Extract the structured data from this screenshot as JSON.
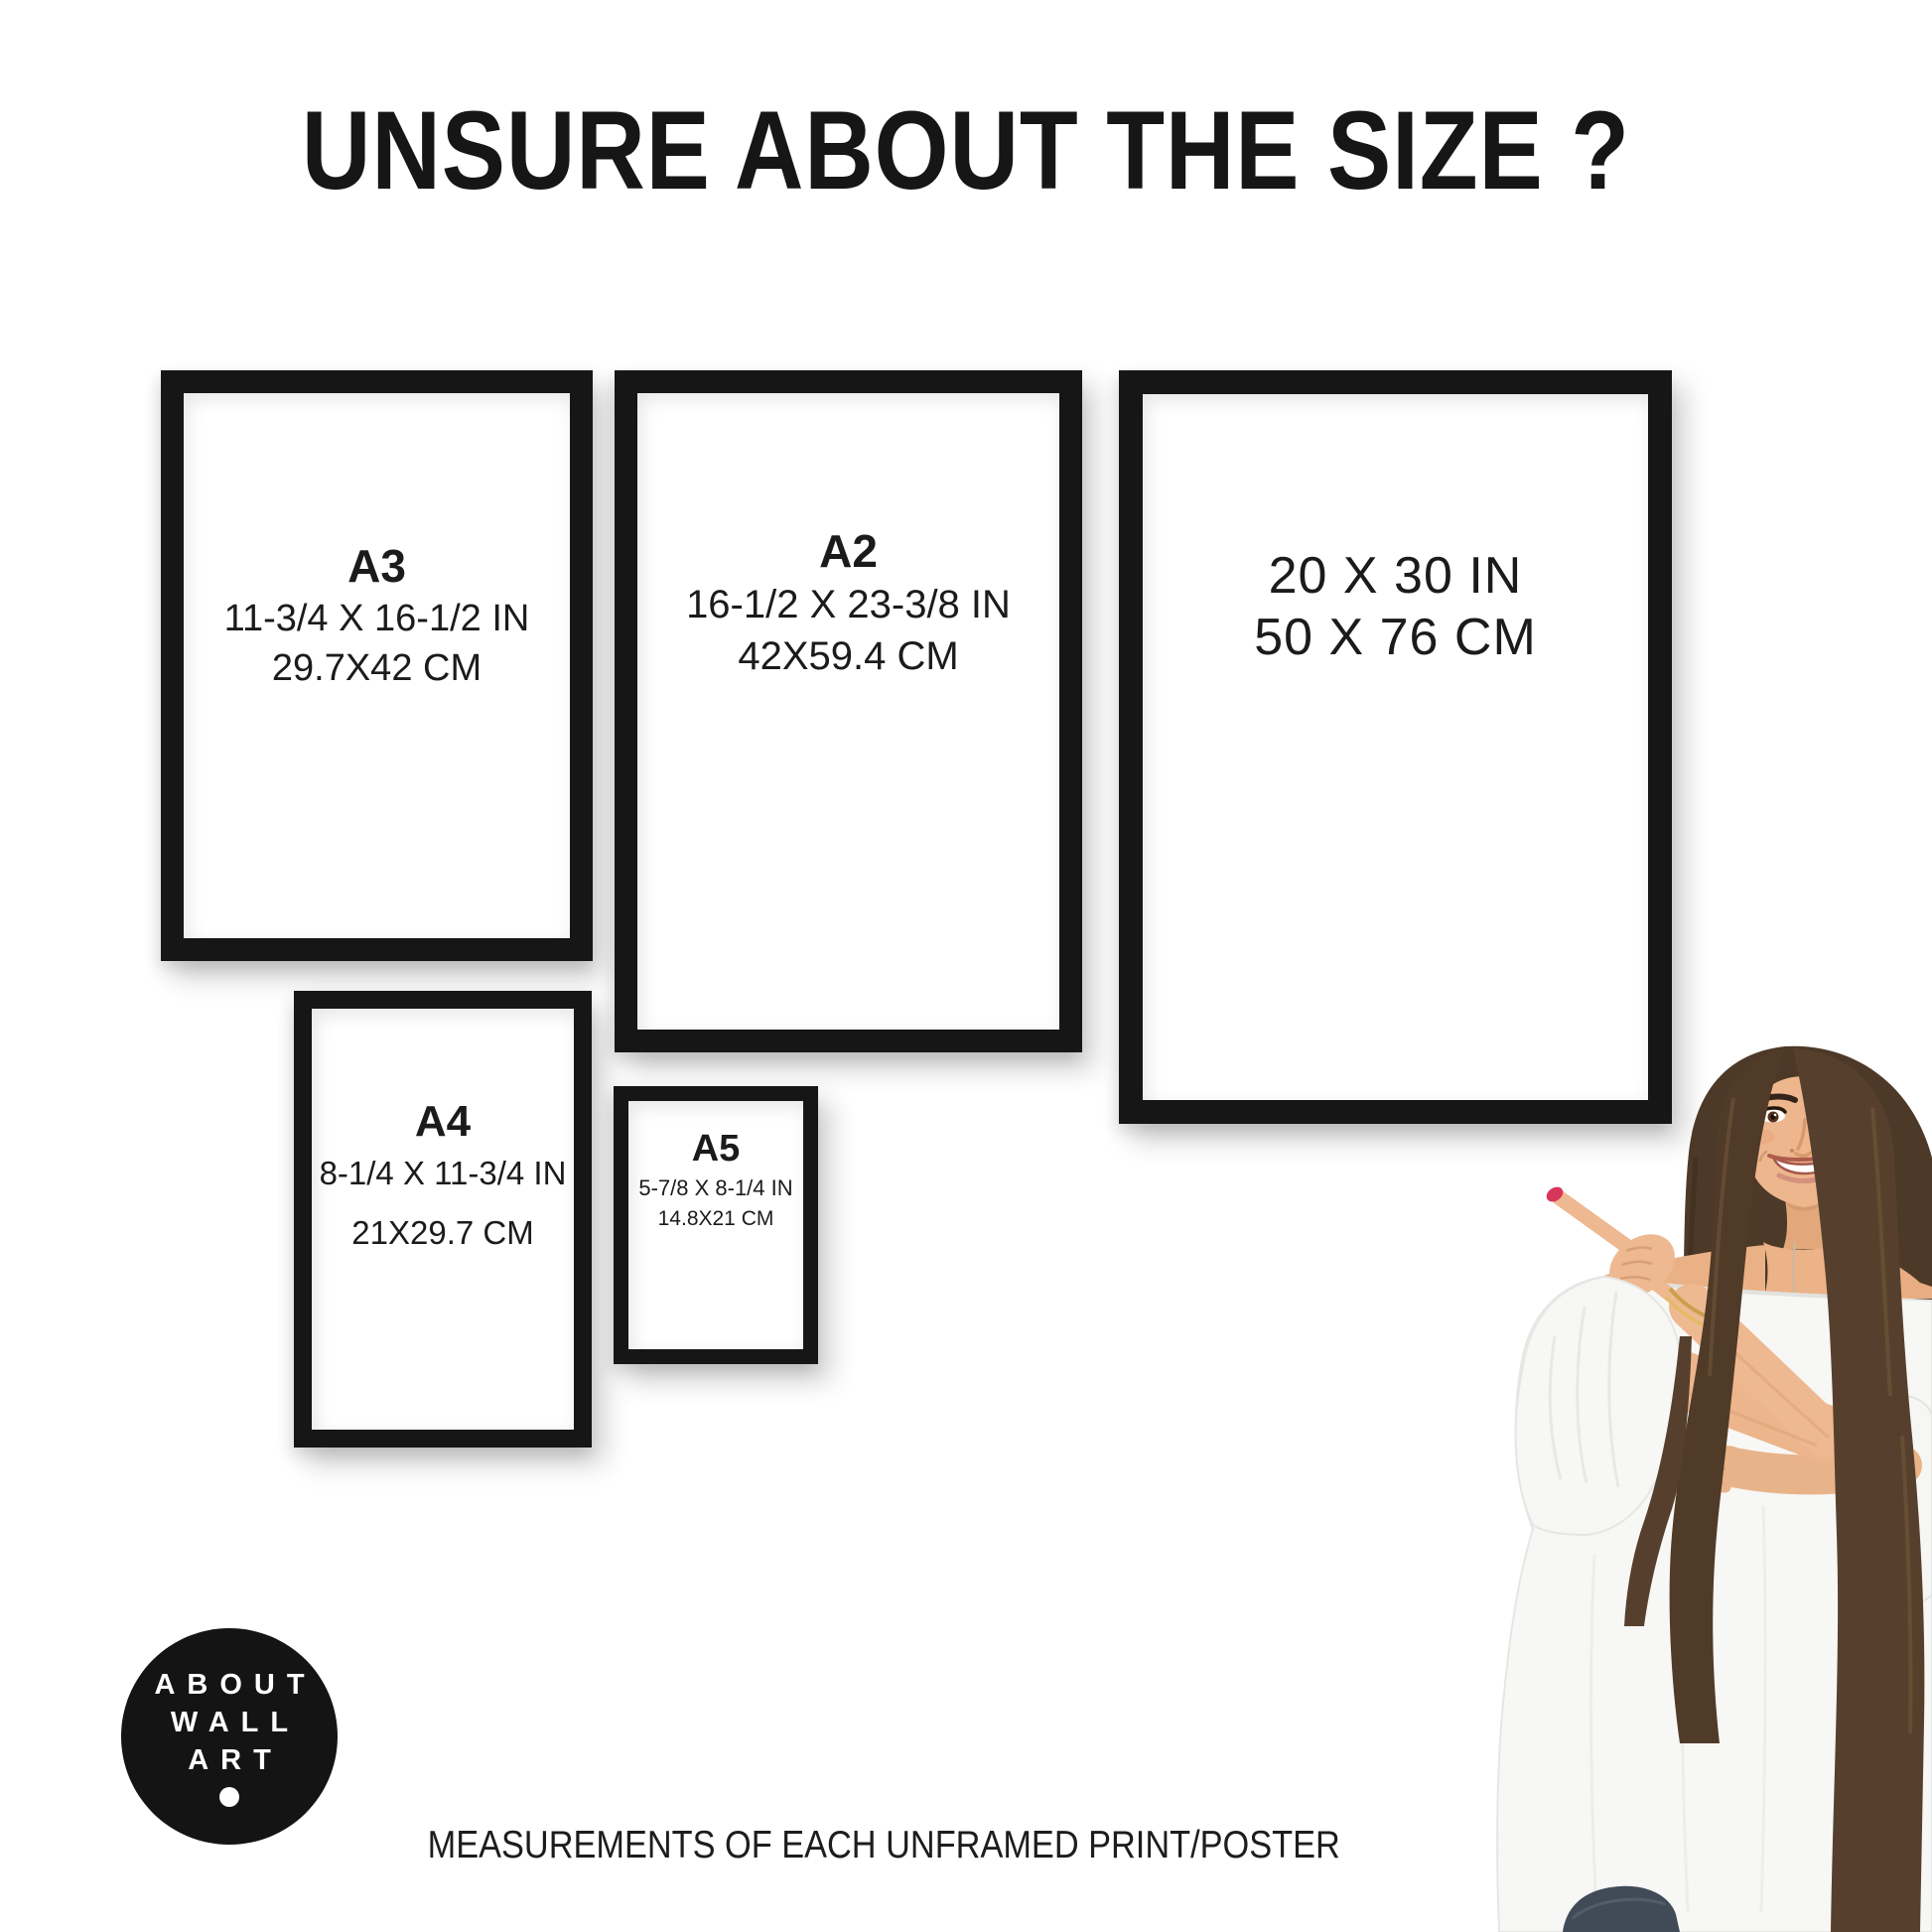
{
  "header": {
    "title": "UNSURE ABOUT THE SIZE ?"
  },
  "frames": [
    {
      "name": "A3",
      "label": "A3",
      "inches": "11-3/4 X 16-1/2 IN",
      "cm": "29.7X42 CM"
    },
    {
      "name": "A2",
      "label": "A2",
      "inches": "16-1/2 X 23-3/8 IN",
      "cm": "42X59.4 CM"
    },
    {
      "name": "20x30",
      "inches": "20 X 30 IN",
      "cm": "50 X 76 CM"
    },
    {
      "name": "A4",
      "label": "A4",
      "inches": "8-1/4 X 11-3/4 IN",
      "cm": "21X29.7 CM"
    },
    {
      "name": "A5",
      "label": "A5",
      "inches": "5-7/8 X 8-1/4 IN",
      "cm": "14.8X21 CM"
    }
  ],
  "logo": {
    "line1": "ABOUT",
    "line2": "WALL",
    "line3": "ART"
  },
  "footer": {
    "caption": "MEASUREMENTS OF EACH UNFRAMED PRINT/POSTER"
  },
  "colors": {
    "frame_black": "#161616",
    "background": "#ffffff",
    "logo_background": "#141414",
    "logo_text": "#ffffff",
    "nail_red": "#d7365a",
    "hair_brown": "#4d3927",
    "skin": "#edb68d"
  }
}
